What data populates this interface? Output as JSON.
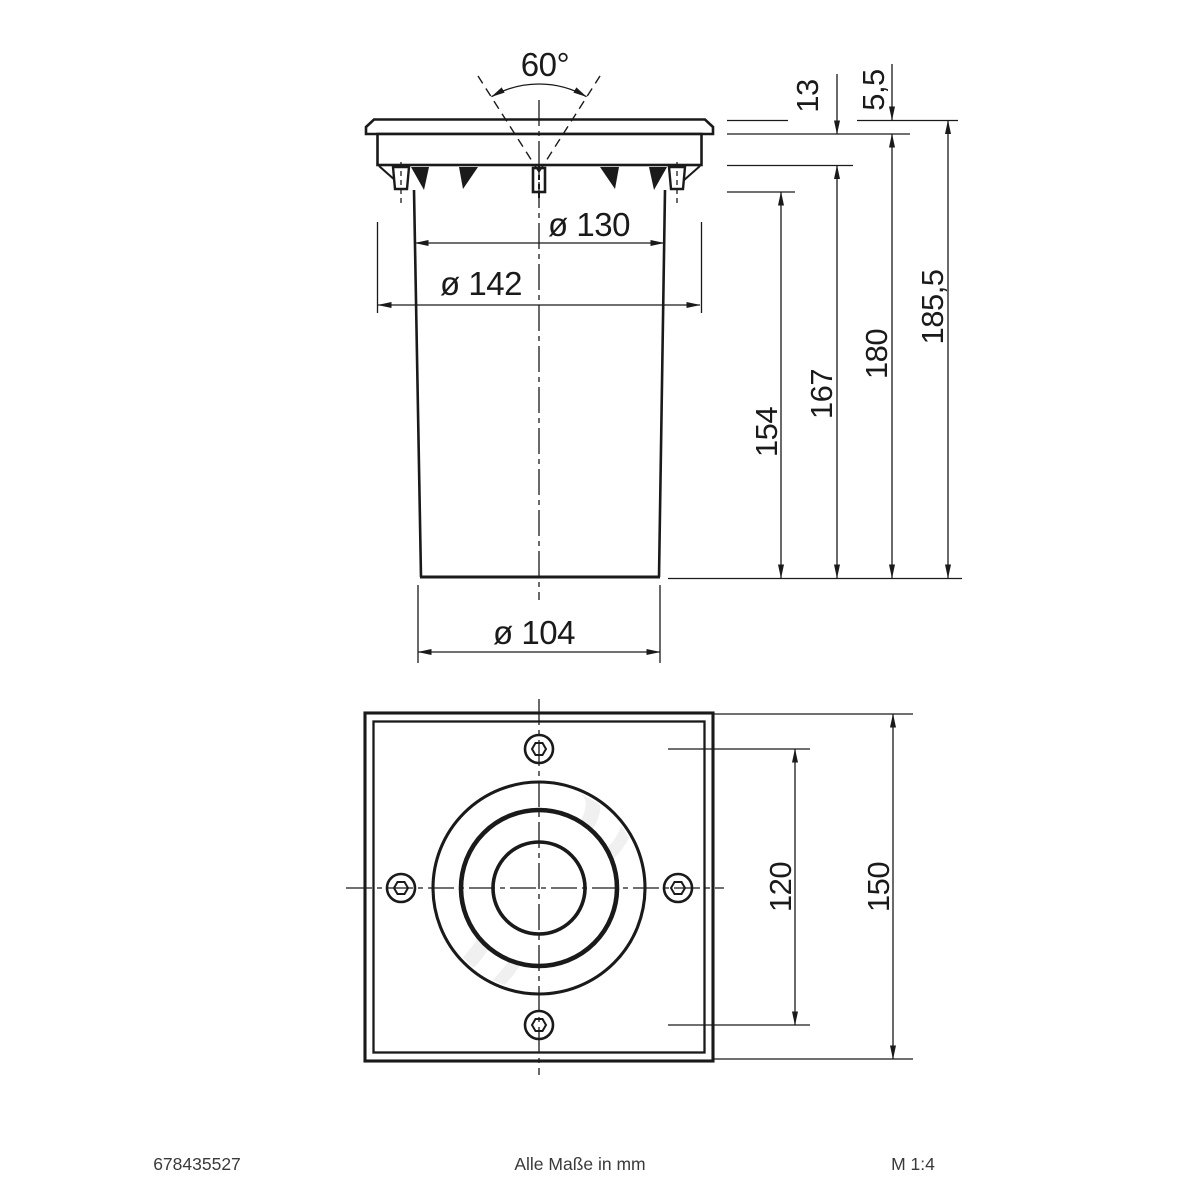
{
  "side_view": {
    "beam_angle": "60°",
    "dia_cutout": "ø 130",
    "dia_flange": "ø 142",
    "dia_body": "ø 104",
    "height_body": "154",
    "height_with_clips": "167",
    "height_below_cover": "180",
    "height_total": "185,5",
    "collar_height": "13",
    "cover_height": "5,5"
  },
  "front_view": {
    "screw_spacing": "120",
    "plate_size": "150"
  },
  "footer": {
    "article_number": "678435527",
    "units_note": "Alle Maße in mm",
    "scale": "M 1:4"
  },
  "colors": {
    "line": "#1a1a1a",
    "lens_fill": "#ececec",
    "watermark": "#e4e4e4"
  }
}
